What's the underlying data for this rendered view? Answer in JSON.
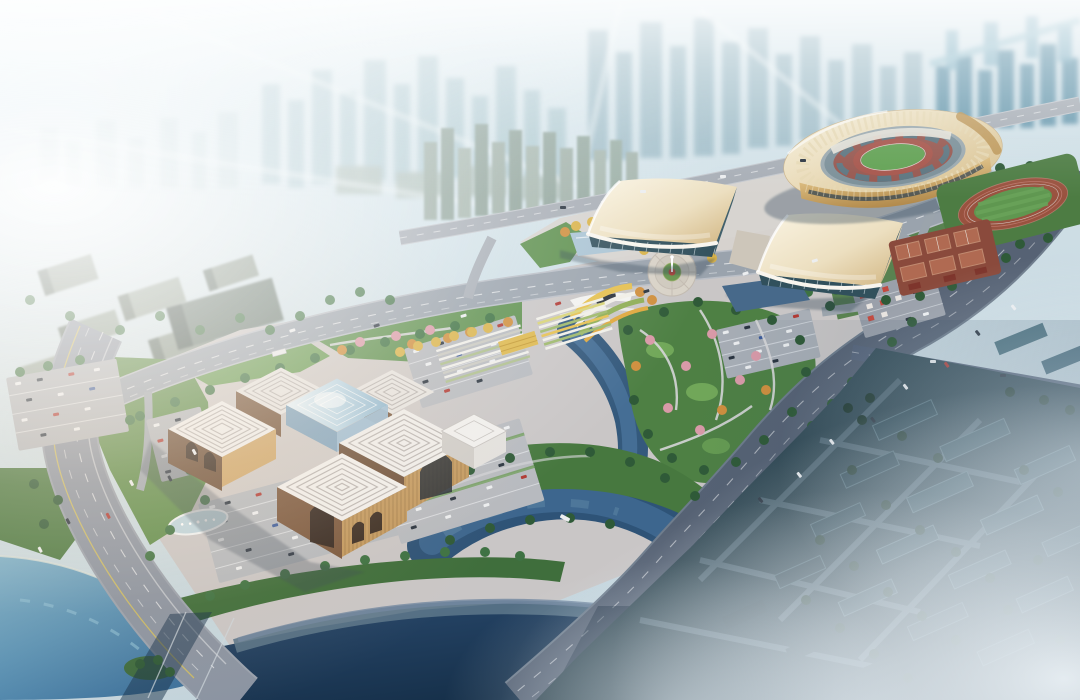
{
  "image": {
    "description": "Aerial architectural rendering at dusk of a civic sports and culture district: an oval stadium with athletics track and red tennis courts at upper right, two exhibition halls with curved golden roofs around a circular fountain plaza in the center, a cultural center with concentric-square patterned roofs and a glass atrium at lower left, landscaped gardens with pink and yellow trees, crescent ponds, a river with road bridges, large parking lots with cars, multi-lane boulevards with traffic, a hazy high-rise skyline behind, strong sun glare from the upper left and fog over the lower right residential blocks."
  },
  "palette": {
    "sky_haze": "#dfeef7",
    "glare_white": "#ffffff",
    "far_city": "#a9c4cf",
    "teal_city": "#5f93a9",
    "mid_city_block": "#8b9a90",
    "complex_paving": "#c9c6c6",
    "forecourt_paving": "#d7d3cf",
    "plaza_ring": "#d8d2c7",
    "avenue_road": "#9aa3ad",
    "boulevard_road": "#566274",
    "highway_road": "#8b94a2",
    "road_marking": "#ffffff",
    "lane_yellow": "#d8c35a",
    "water_deep": "#1f3c5c",
    "water_river": "#2e5377",
    "water_lake": "#4e86ad",
    "reflecting_pool": "#aac4d4",
    "park_green": "#4e8044",
    "lawn_green": "#76ab5c",
    "tree_dark": "#2f5a38",
    "tree_yellow": "#d9b34a",
    "tree_orange": "#cf8f3e",
    "tree_pink": "#d99aa8",
    "hall_roof_light": "#faf4e3",
    "hall_roof_gold": "#d7bd8a",
    "hall_glass": "#34525e",
    "stadium_ring_cream": "#f3e8cc",
    "stadium_gold": "#c9a261",
    "stadium_seats_red": "#96564e",
    "pitch_green": "#61a152",
    "track_red": "#a6544a",
    "culture_roof": "#edebe8",
    "culture_roof_groove": "#bab5b2",
    "culture_facade_tan": "#c79e63",
    "culture_facade_shadow": "#6e5039",
    "atrium_glass": "#9cc0d8",
    "courts_red": "#a84f3e",
    "residential_block": "#2f4a56",
    "residential_tree": "#1d362e",
    "fog": "#eef4f8",
    "car_white": "#eceef0",
    "car_dark": "#2a3440",
    "car_red": "#b03a34"
  }
}
